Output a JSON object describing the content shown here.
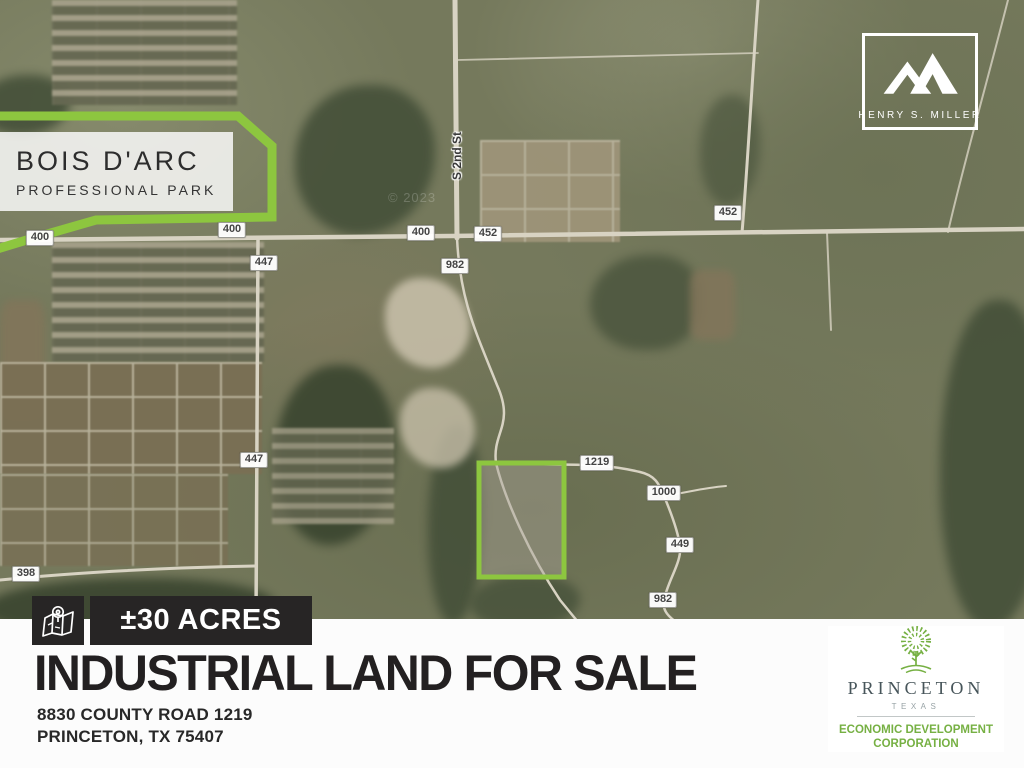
{
  "colors": {
    "accent_green": "#8dc63f",
    "badge_black": "#272525",
    "edc_green": "#76b043",
    "title_ink": "#232021"
  },
  "map": {
    "street_label": "S 2nd St",
    "watermark": "© 2023",
    "bois_darc": {
      "line1": "BOIS D'ARC",
      "line2": "PROFESSIONAL PARK"
    },
    "road_labels": [
      {
        "text": "400",
        "x": 232,
        "y": 230
      },
      {
        "text": "447",
        "x": 264,
        "y": 263
      },
      {
        "text": "400",
        "x": 421,
        "y": 233
      },
      {
        "text": "452",
        "x": 488,
        "y": 234
      },
      {
        "text": "982",
        "x": 455,
        "y": 266
      },
      {
        "text": "452",
        "x": 728,
        "y": 213
      },
      {
        "text": "447",
        "x": 254,
        "y": 460
      },
      {
        "text": "1219",
        "x": 597,
        "y": 463
      },
      {
        "text": "1000",
        "x": 664,
        "y": 493
      },
      {
        "text": "449",
        "x": 680,
        "y": 545
      },
      {
        "text": "982",
        "x": 663,
        "y": 600
      },
      {
        "text": "398",
        "x": 26,
        "y": 574
      },
      {
        "text": "400",
        "x": 40,
        "y": 238,
        "under": true
      }
    ]
  },
  "logos": {
    "henry_s_miller": {
      "label": "HENRY S. MILLER"
    },
    "princeton_edc": {
      "city": "PRINCETON",
      "state": "TEXAS",
      "org_line1": "ECONOMIC DEVELOPMENT",
      "org_line2": "CORPORATION"
    }
  },
  "banner": {
    "acreage_badge": "±30 ACRES",
    "title": "INDUSTRIAL LAND FOR SALE",
    "address_line1": "8830 COUNTY ROAD 1219",
    "address_line2": "PRINCETON, TX 75407"
  }
}
